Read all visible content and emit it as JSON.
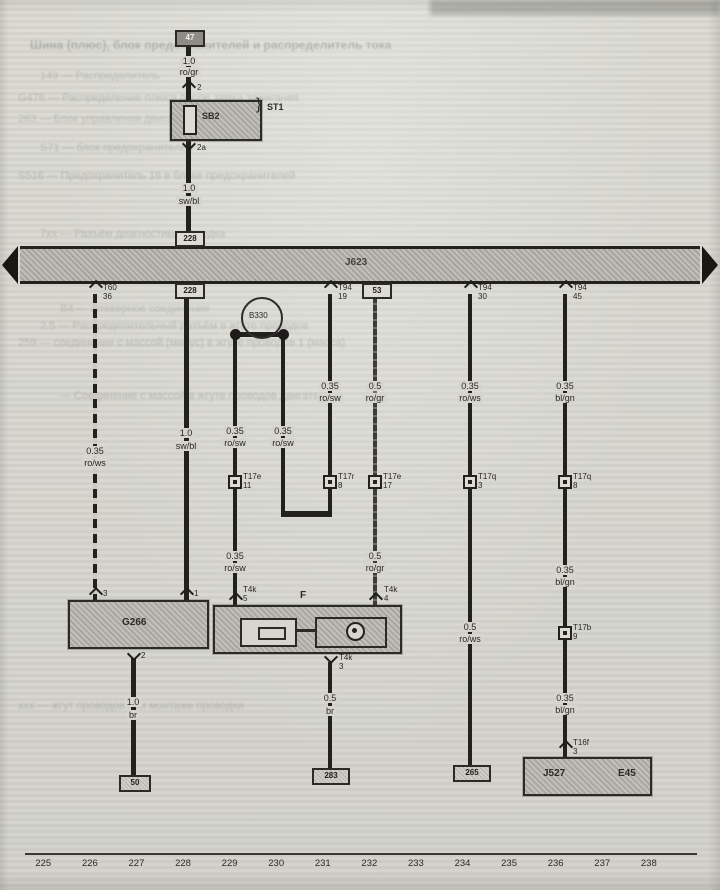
{
  "feed": {
    "source_box": "47",
    "wire1_size": "1.0",
    "wire1_color": "ro/gr",
    "pin_top": "2",
    "fuse_label": "SB2",
    "fuse_holder": "ST1",
    "pin_bottom": "2a",
    "wire2_size": "1.0",
    "wire2_color": "sw/bl",
    "entry_box": "228"
  },
  "ecu": {
    "label": "J623"
  },
  "b330": {
    "label": "B330"
  },
  "branch1": {
    "pin": "T60",
    "pin_no": "36",
    "size": "0.35",
    "color": "ro/ws",
    "comp_pin": "3"
  },
  "branch2": {
    "box": "228",
    "size": "1.0",
    "color": "sw/bl",
    "comp_pin": "1"
  },
  "branch3": {
    "size1": "0.35",
    "color1": "ro/sw",
    "conn": "T17e",
    "conn_no": "11",
    "size2": "0.35",
    "color2": "ro/sw",
    "pin": "T4k",
    "pin_no": "5"
  },
  "branch4": {
    "size": "0.35",
    "color": "ro/sw"
  },
  "branch5": {
    "pin": "T94",
    "pin_no": "19",
    "size": "0.35",
    "color": "ro/sw",
    "conn": "T17r",
    "conn_no": "8"
  },
  "branch6": {
    "box": "53",
    "size1": "0.5",
    "color1": "ro/gr",
    "conn": "T17e",
    "conn_no": "17",
    "size2": "0.5",
    "color2": "ro/gr",
    "pin": "T4k",
    "pin_no": "4"
  },
  "branch7": {
    "pin": "T94",
    "pin_no": "30",
    "size1": "0.35",
    "color1": "ro/ws",
    "conn": "T17q",
    "conn_no": "3",
    "size2": "0.5",
    "color2": "ro/ws",
    "end_box": "265"
  },
  "branch8": {
    "pin": "T94",
    "pin_no": "45",
    "size1": "0.35",
    "color1": "bl/gn",
    "conn1": "T17q",
    "conn1_no": "8",
    "size2": "0.35",
    "color2": "bl/gn",
    "conn2": "T17b",
    "conn2_no": "9",
    "size3": "0.35",
    "color3": "bl/gn",
    "conn3": "T16f",
    "conn3_no": "3"
  },
  "g266": {
    "label": "G266",
    "pin_bottom": "2",
    "wire_size": "1.0",
    "wire_color": "br",
    "ground": "50"
  },
  "f_switch": {
    "label": "F",
    "pin_bottom": "T4k",
    "pin_bottom_no": "3",
    "wire_size": "0.5",
    "wire_color": "br",
    "ground": "283"
  },
  "unit": {
    "left": "J527",
    "right": "E45"
  },
  "tracks": [
    "225",
    "226",
    "227",
    "228",
    "229",
    "230",
    "231",
    "232",
    "233",
    "234",
    "235",
    "236",
    "237",
    "238"
  ],
  "ghost": [
    "Шина (плюс), блок предохранителей и распределитель тока",
    "149 — Распределитель",
    "G476 — Распределение плюса после замка зажигания",
    "263 — Блок управления двигателя",
    "S71 — блок предохранителей",
    "S516 — Предохранитель 16 в блоке предохранителей",
    "7хх — Разъём диагностики, колодка",
    "В4 — штекерное соединение",
    "2.5 — Распределительный разъём в жгуте проводов",
    "259 — соединение с массой (минус) в жгуте проводов 1 (масса)",
    "— Соединение с массой в жгуте проводов двигателя",
    "ххх — жгут проводов при монтаже проводки"
  ]
}
